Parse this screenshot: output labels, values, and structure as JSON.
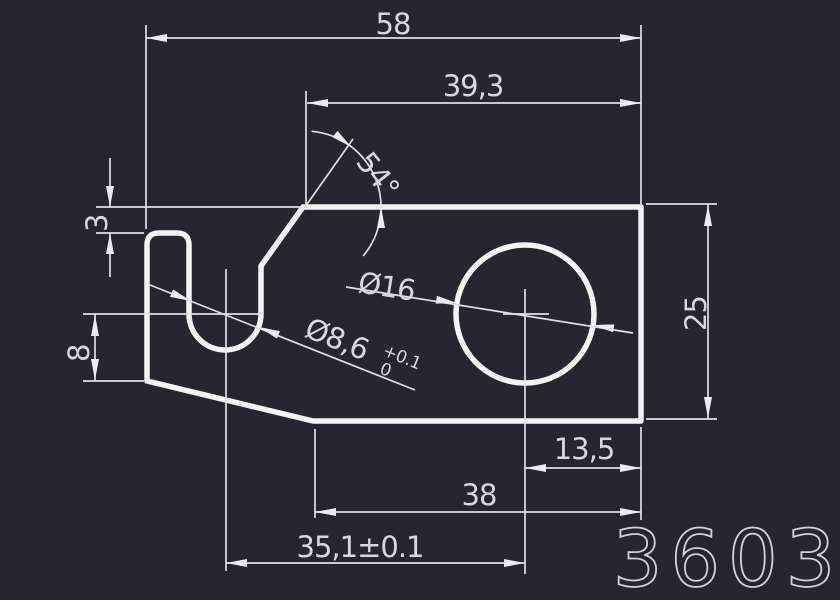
{
  "canvas": {
    "background": "#24282e",
    "line_color": "#f1f3f5",
    "dim_text_color": "#d6d9db"
  },
  "title_block": {
    "part_number": "3603"
  },
  "dimensions": {
    "total_width": "58",
    "top_width": "39,3",
    "bend_angle": "54°",
    "ledge_depth": "3",
    "slot_center_height": "8",
    "hole_diameter": "Ø16",
    "slot_diameter": "Ø8,6",
    "slot_tolerance_upper": "+0.1",
    "slot_tolerance_lower": "0",
    "plate_height": "25",
    "hole_to_right_edge": "13,5",
    "bottom_width": "38",
    "slot_to_hole_distance": "35,1±0.1"
  }
}
